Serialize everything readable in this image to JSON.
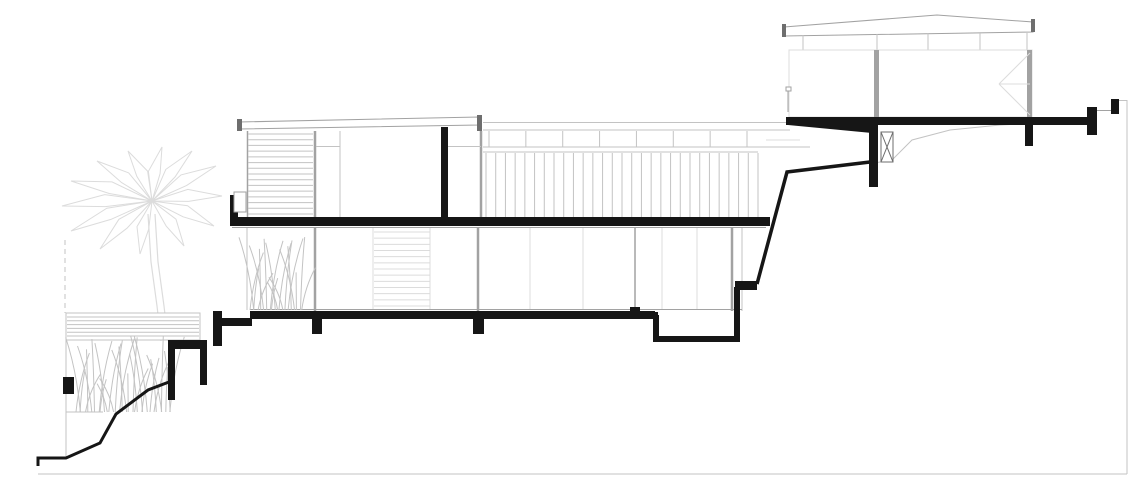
{
  "canvas": {
    "width": 1146,
    "height": 498,
    "background": "#ffffff"
  },
  "colors": {
    "cut": "#161616",
    "dark": "#6e6e6e",
    "mid": "#a2a2a2",
    "light": "#c3c3c3",
    "faint": "#dcdcdc",
    "white": "#ffffff"
  },
  "drawing": {
    "shapes": [
      {
        "n": "palm-crown",
        "k": "palm",
        "cx": 152,
        "cy": 201,
        "tips": [
          [
            222,
            196
          ],
          [
            216,
            166
          ],
          [
            192,
            151
          ],
          [
            162,
            147
          ],
          [
            128,
            151
          ],
          [
            97,
            161
          ],
          [
            71,
            181
          ],
          [
            62,
            206
          ],
          [
            71,
            231
          ],
          [
            100,
            249
          ],
          [
            140,
            254
          ],
          [
            184,
            246
          ],
          [
            214,
            226
          ]
        ],
        "c": "faint"
      },
      {
        "n": "palm-trunk-line",
        "k": "pline",
        "pts": [
          [
            148,
            214
          ],
          [
            151,
            262
          ],
          [
            157,
            306
          ],
          [
            161,
            341
          ]
        ],
        "c": "faint",
        "w": 1.2
      },
      {
        "n": "palm-trunk-line",
        "k": "pline",
        "pts": [
          [
            155,
            214
          ],
          [
            158,
            262
          ],
          [
            164,
            306
          ],
          [
            168,
            341
          ]
        ],
        "c": "faint",
        "w": 1.2
      },
      {
        "n": "site-boundary-dashed",
        "k": "line",
        "x1": 65,
        "y1": 240,
        "x2": 65,
        "y2": 313,
        "c": "light",
        "w": 1,
        "dash": "5,4"
      },
      {
        "n": "terrace-edge-line",
        "k": "line",
        "x1": 66,
        "y1": 313,
        "x2": 66,
        "y2": 458,
        "c": "light",
        "w": 1
      },
      {
        "n": "terrace-base-line",
        "k": "line",
        "x1": 66,
        "y1": 412,
        "x2": 103,
        "y2": 412,
        "c": "light",
        "w": 1
      },
      {
        "n": "deck-outline",
        "k": "rect",
        "x": 66,
        "y": 313,
        "wd": 134,
        "ht": 27,
        "f": "white",
        "sc": "light",
        "w": 1
      },
      {
        "n": 6,
        "k": "hlines",
        "x": 67,
        "y": 317,
        "wd": 132,
        "ht": 19,
        "c": "light",
        "w": 1
      },
      {
        "n": 32,
        "k": "grass",
        "x": 76,
        "wd": 96,
        "base": 412,
        "ht": 80,
        "c": "light"
      },
      {
        "n": "main-roof",
        "k": "poly",
        "pts": [
          [
            239,
            122
          ],
          [
            479,
            117
          ],
          [
            479,
            125
          ],
          [
            239,
            129
          ]
        ],
        "f": "white",
        "sc": "mid",
        "w": 1
      },
      {
        "n": "main-roof-cap-left",
        "k": "rect",
        "x": 237,
        "y": 119,
        "wd": 5,
        "ht": 12,
        "f": "dark"
      },
      {
        "n": "main-roof-cap-right",
        "k": "rect",
        "x": 477,
        "y": 115,
        "wd": 5,
        "ht": 16,
        "f": "dark"
      },
      {
        "n": "louver-screen-edge",
        "k": "line",
        "x1": 247.5,
        "y1": 131,
        "x2": 247.5,
        "y2": 218,
        "c": "mid",
        "w": 1.5
      },
      {
        "n": 15,
        "k": "hlines",
        "x": 248,
        "y": 134,
        "wd": 65,
        "ht": 80,
        "c": "light",
        "w": 1
      },
      {
        "n": "facade-mullion",
        "k": "line",
        "x1": 315,
        "y1": 131,
        "x2": 315,
        "y2": 218,
        "c": "mid",
        "w": 2.5
      },
      {
        "n": "transom-line",
        "k": "line",
        "x1": 316,
        "y1": 146.5,
        "x2": 340,
        "y2": 146.5,
        "c": "light",
        "w": 1
      },
      {
        "n": "facade-mullion-thin",
        "k": "line",
        "x1": 340,
        "y1": 131,
        "x2": 340,
        "y2": 218,
        "c": "light",
        "w": 1
      },
      {
        "n": "facade-mullion",
        "k": "line",
        "x1": 481,
        "y1": 131,
        "x2": 481,
        "y2": 217,
        "c": "mid",
        "w": 2.5
      },
      {
        "n": "transom-line",
        "k": "line",
        "x1": 448,
        "y1": 146.5,
        "x2": 481,
        "y2": 146.5,
        "c": "light",
        "w": 1
      },
      {
        "n": "terrace-roof-edge",
        "k": "line",
        "x1": 483,
        "y1": 122.5,
        "x2": 788,
        "y2": 122.5,
        "c": "light",
        "w": 1
      },
      {
        "n": "terrace-fascia-line",
        "k": "line",
        "x1": 483,
        "y1": 130,
        "x2": 790,
        "y2": 130,
        "c": "light",
        "w": 1
      },
      {
        "n": 8,
        "k": "vlines",
        "x": 489,
        "y": 131,
        "wd": 258,
        "ht": 16,
        "c": "light",
        "w": 1
      },
      {
        "n": "terrace-fascia-bottom",
        "k": "line",
        "x1": 483,
        "y1": 147,
        "x2": 810,
        "y2": 147,
        "c": "light",
        "w": 1
      },
      {
        "n": "terrace-rail-line",
        "k": "line",
        "x1": 483,
        "y1": 152,
        "x2": 758,
        "y2": 152,
        "c": "light",
        "w": 1
      },
      {
        "n": 29,
        "k": "vlines",
        "x": 486,
        "y": 153,
        "wd": 272,
        "ht": 64,
        "c": "light",
        "w": 1
      },
      {
        "n": "upper-rail-extra",
        "k": "line",
        "x1": 766,
        "y1": 140,
        "x2": 800,
        "y2": 140,
        "c": "faint",
        "w": 1
      },
      {
        "n": "slab-soffit-line",
        "k": "line",
        "x1": 232,
        "y1": 227.5,
        "x2": 766,
        "y2": 227.5,
        "c": "mid",
        "w": 1
      },
      {
        "n": "groundfloor-wall-edge",
        "k": "line",
        "x1": 247,
        "y1": 228,
        "x2": 247,
        "y2": 310,
        "c": "light",
        "w": 1
      },
      {
        "n": "glazing-mullion",
        "k": "line",
        "x1": 315,
        "y1": 228,
        "x2": 315,
        "y2": 311,
        "c": "mid",
        "w": 2.5
      },
      {
        "n": "glazing-mullion",
        "k": "line",
        "x1": 478,
        "y1": 228,
        "x2": 478,
        "y2": 311,
        "c": "mid",
        "w": 2.5
      },
      {
        "n": "glazing-mullion",
        "k": "line",
        "x1": 635,
        "y1": 228,
        "x2": 635,
        "y2": 312,
        "c": "mid",
        "w": 1.5
      },
      {
        "n": "glazing-mullion",
        "k": "line",
        "x1": 732,
        "y1": 228,
        "x2": 732,
        "y2": 311,
        "c": "mid",
        "w": 2.5
      },
      {
        "n": "glazing-end-line",
        "k": "line",
        "x1": 742,
        "y1": 228,
        "x2": 742,
        "y2": 311,
        "c": "light",
        "w": 1
      },
      {
        "n": "glazing-thin-mullion",
        "k": "line",
        "x1": 373,
        "y1": 228,
        "x2": 373,
        "y2": 309,
        "c": "faint",
        "w": 1
      },
      {
        "n": "glazing-thin-mullion",
        "k": "line",
        "x1": 430,
        "y1": 228,
        "x2": 430,
        "y2": 309,
        "c": "faint",
        "w": 1
      },
      {
        "n": "glazing-thin-mullion",
        "k": "line",
        "x1": 530,
        "y1": 228,
        "x2": 530,
        "y2": 309,
        "c": "faint",
        "w": 1
      },
      {
        "n": "glazing-thin-mullion",
        "k": "line",
        "x1": 583,
        "y1": 228,
        "x2": 583,
        "y2": 309,
        "c": "faint",
        "w": 1
      },
      {
        "n": "glazing-thin-mullion",
        "k": "line",
        "x1": 662,
        "y1": 228,
        "x2": 662,
        "y2": 309,
        "c": "faint",
        "w": 1
      },
      {
        "n": "glazing-thin-mullion",
        "k": "line",
        "x1": 697,
        "y1": 228,
        "x2": 697,
        "y2": 309,
        "c": "faint",
        "w": 1
      },
      {
        "n": "sill-line",
        "k": "line",
        "x1": 250,
        "y1": 309.5,
        "x2": 742,
        "y2": 309.5,
        "c": "mid",
        "w": 1
      },
      {
        "n": 13,
        "k": "hlines",
        "x": 374,
        "y": 232,
        "wd": 56,
        "ht": 74,
        "c": "faint",
        "w": 1
      },
      {
        "n": 20,
        "k": "grass",
        "x": 250,
        "wd": 52,
        "base": 310,
        "ht": 78,
        "c": "light"
      },
      {
        "n": "pavilion-roof",
        "k": "poly",
        "pts": [
          [
            784,
            27
          ],
          [
            937,
            15
          ],
          [
            1033,
            22
          ],
          [
            1033,
            32
          ],
          [
            784,
            36
          ]
        ],
        "f": "white",
        "sc": "mid",
        "w": 1
      },
      {
        "n": "pavilion-roof-cap-left",
        "k": "rect",
        "x": 782,
        "y": 24,
        "wd": 4,
        "ht": 13,
        "f": "dark"
      },
      {
        "n": "pavilion-roof-cap-right",
        "k": "rect",
        "x": 1031,
        "y": 19,
        "wd": 4,
        "ht": 13,
        "f": "dark"
      },
      {
        "n": "clerestory-bottom-line",
        "k": "line",
        "x1": 789,
        "y1": 50,
        "x2": 1031,
        "y2": 50,
        "c": "light",
        "w": 1
      },
      {
        "n": "clerestory-mullion",
        "k": "line",
        "x1": 803,
        "y1": 35,
        "x2": 803,
        "y2": 50,
        "c": "light",
        "w": 1
      },
      {
        "n": "clerestory-mullion",
        "k": "line",
        "x1": 877,
        "y1": 34,
        "x2": 877,
        "y2": 50,
        "c": "light",
        "w": 1
      },
      {
        "n": "clerestory-mullion",
        "k": "line",
        "x1": 928,
        "y1": 33,
        "x2": 928,
        "y2": 50,
        "c": "light",
        "w": 1
      },
      {
        "n": "clerestory-mullion",
        "k": "line",
        "x1": 980,
        "y1": 33,
        "x2": 980,
        "y2": 50,
        "c": "light",
        "w": 1
      },
      {
        "n": "clerestory-mullion",
        "k": "line",
        "x1": 1027,
        "y1": 33,
        "x2": 1027,
        "y2": 50,
        "c": "light",
        "w": 1
      },
      {
        "n": "pavilion-body-outline",
        "k": "rect",
        "x": 789,
        "y": 50,
        "wd": 243,
        "ht": 67,
        "f": "none",
        "sc": "faint",
        "w": 1
      },
      {
        "n": "pavilion-post",
        "k": "rect",
        "x": 874,
        "y": 50,
        "wd": 5,
        "ht": 67,
        "f": "mid"
      },
      {
        "n": "pavilion-post",
        "k": "rect",
        "x": 1027,
        "y": 50,
        "wd": 5,
        "ht": 67,
        "f": "mid"
      },
      {
        "n": "door-swing-line",
        "k": "line",
        "x1": 1030,
        "y1": 53,
        "x2": 999,
        "y2": 84,
        "c": "faint",
        "w": 1
      },
      {
        "n": "door-swing-line",
        "k": "line",
        "x1": 1030,
        "y1": 115,
        "x2": 999,
        "y2": 84,
        "c": "faint",
        "w": 1
      },
      {
        "n": "door-swing-line",
        "k": "line",
        "x1": 999,
        "y1": 84,
        "x2": 1030,
        "y2": 84,
        "c": "faint",
        "w": 1
      },
      {
        "n": "rail-post-marker",
        "k": "rect",
        "x": 786,
        "y": 87,
        "wd": 5,
        "ht": 4,
        "f": "white",
        "sc": "mid",
        "w": 1
      },
      {
        "n": "rail-post-line",
        "k": "line",
        "x1": 788,
        "y1": 91,
        "x2": 788,
        "y2": 112,
        "c": "mid",
        "w": 1
      },
      {
        "n": "natural-grade-line",
        "k": "pline",
        "pts": [
          [
            874,
            163
          ],
          [
            892,
            160
          ],
          [
            912,
            140
          ],
          [
            950,
            130
          ],
          [
            1000,
            125
          ],
          [
            1060,
            122
          ],
          [
            1088,
            120
          ]
        ],
        "c": "light",
        "w": 1
      },
      {
        "n": "plot-boundary-right",
        "k": "line",
        "x1": 1127,
        "y1": 100,
        "x2": 1127,
        "y2": 474,
        "c": "light",
        "w": 1
      },
      {
        "n": "site-baseline",
        "k": "line",
        "x1": 38,
        "y1": 474,
        "x2": 1127,
        "y2": 474,
        "c": "light",
        "w": 1
      },
      {
        "n": "parapet-link-line",
        "k": "line",
        "x1": 1097,
        "y1": 110.5,
        "x2": 1111,
        "y2": 110.5,
        "c": "mid",
        "w": 1
      },
      {
        "n": "boundary-link-line",
        "k": "line",
        "x1": 1119,
        "y1": 100.5,
        "x2": 1127,
        "y2": 100.5,
        "c": "light",
        "w": 1
      },
      {
        "n": "section-wall",
        "k": "rect",
        "x": 441,
        "y": 127,
        "wd": 7,
        "ht": 92,
        "f": "cut"
      },
      {
        "n": "upper-floor-slab",
        "k": "rect",
        "x": 230,
        "y": 217,
        "wd": 540,
        "ht": 9,
        "f": "cut"
      },
      {
        "n": "slab-upturn",
        "k": "rect",
        "x": 230,
        "y": 195,
        "wd": 8,
        "ht": 23,
        "f": "cut"
      },
      {
        "n": "parapet-planter",
        "k": "rect",
        "x": 234,
        "y": 192,
        "wd": 12,
        "ht": 20,
        "f": "white",
        "sc": "mid",
        "w": 1
      },
      {
        "n": "step-wall",
        "k": "rect",
        "x": 213,
        "y": 311,
        "wd": 9,
        "ht": 35,
        "f": "cut"
      },
      {
        "n": "step-slab",
        "k": "rect",
        "x": 222,
        "y": 318,
        "wd": 30,
        "ht": 8,
        "f": "cut"
      },
      {
        "n": "groundfloor-slab",
        "k": "rect",
        "x": 250,
        "y": 311,
        "wd": 405,
        "ht": 8,
        "f": "cut"
      },
      {
        "n": "slab-footing",
        "k": "rect",
        "x": 312,
        "y": 319,
        "wd": 10,
        "ht": 15,
        "f": "cut"
      },
      {
        "n": "slab-footing",
        "k": "rect",
        "x": 473,
        "y": 319,
        "wd": 11,
        "ht": 15,
        "f": "cut"
      },
      {
        "n": "slab-step-nub",
        "k": "rect",
        "x": 630,
        "y": 307,
        "wd": 10,
        "ht": 5,
        "f": "cut"
      },
      {
        "n": "groundfloor-slab-lower",
        "k": "rect",
        "x": 630,
        "y": 312,
        "wd": 28,
        "ht": 7,
        "f": "cut"
      },
      {
        "n": "sunken-trough-wall",
        "k": "pline",
        "pts": [
          [
            656,
            315
          ],
          [
            656,
            339
          ],
          [
            737,
            339
          ],
          [
            737,
            287
          ]
        ],
        "c": "cut",
        "w": 6
      },
      {
        "n": "trough-cap",
        "k": "rect",
        "x": 735,
        "y": 281,
        "wd": 22,
        "ht": 9,
        "f": "cut"
      },
      {
        "n": "retaining-wall-top",
        "k": "rect",
        "x": 168,
        "y": 340,
        "wd": 39,
        "ht": 9,
        "f": "cut"
      },
      {
        "n": "retaining-wall-leg",
        "k": "rect",
        "x": 168,
        "y": 349,
        "wd": 7,
        "ht": 51,
        "f": "cut"
      },
      {
        "n": "retaining-wall-leg",
        "k": "rect",
        "x": 200,
        "y": 349,
        "wd": 7,
        "ht": 36,
        "f": "cut"
      },
      {
        "n": "garden-wall",
        "k": "rect",
        "x": 63,
        "y": 377,
        "wd": 11,
        "ht": 17,
        "f": "cut"
      },
      {
        "n": "ground-profile-line",
        "k": "pline",
        "pts": [
          [
            38,
            466
          ],
          [
            38,
            458
          ],
          [
            66,
            458
          ],
          [
            100,
            443
          ],
          [
            116,
            414
          ],
          [
            148,
            390
          ],
          [
            169,
            382
          ]
        ],
        "c": "cut",
        "w": 3
      },
      {
        "n": "terrain-profile-line",
        "k": "pline",
        "pts": [
          [
            757,
            284
          ],
          [
            787,
            172
          ],
          [
            870,
            162
          ]
        ],
        "c": "cut",
        "w": 3.5
      },
      {
        "n": "pavilion-floor-slab",
        "k": "rect",
        "x": 786,
        "y": 117,
        "wd": 306,
        "ht": 8,
        "f": "cut"
      },
      {
        "n": "pavilion-slab-wedge",
        "k": "poly",
        "pts": [
          [
            788,
            125
          ],
          [
            872,
            125
          ],
          [
            872,
            133
          ]
        ],
        "f": "cut"
      },
      {
        "n": "pavilion-pier",
        "k": "rect",
        "x": 869,
        "y": 125,
        "wd": 9,
        "ht": 62,
        "f": "cut"
      },
      {
        "n": "cross-brace-box",
        "k": "xbox",
        "x": 881,
        "y": 132,
        "wd": 12,
        "ht": 30,
        "c": "dark",
        "w": 1
      },
      {
        "n": "pavilion-pier",
        "k": "rect",
        "x": 1025,
        "y": 125,
        "wd": 8,
        "ht": 21,
        "f": "cut"
      },
      {
        "n": "terrace-parapet",
        "k": "rect",
        "x": 1087,
        "y": 107,
        "wd": 10,
        "ht": 28,
        "f": "cut"
      },
      {
        "n": "boundary-post",
        "k": "rect",
        "x": 1111,
        "y": 99,
        "wd": 8,
        "ht": 15,
        "f": "cut"
      }
    ]
  }
}
